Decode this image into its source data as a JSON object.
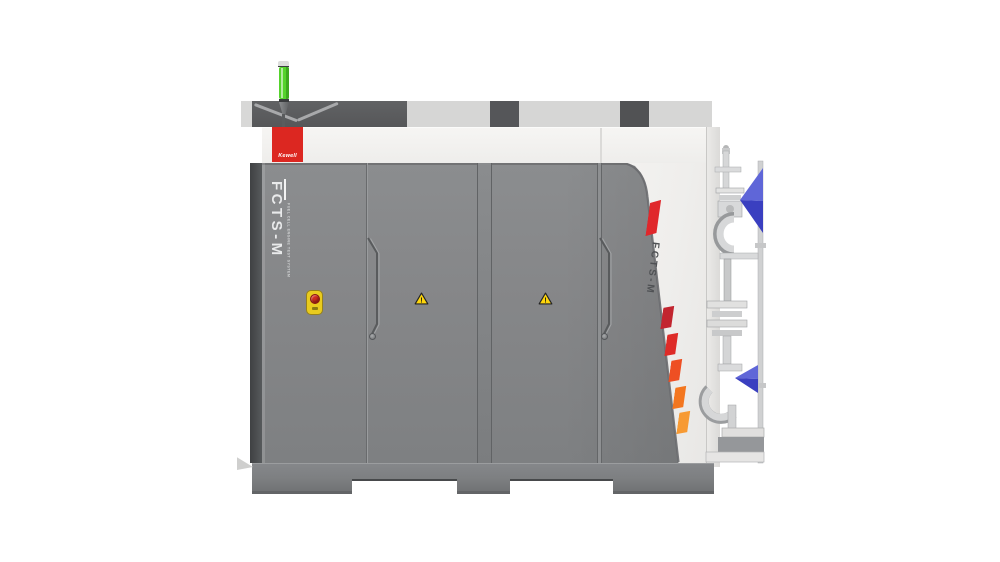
{
  "scene": {
    "background_color": "#ffffff",
    "subject": "Front product render of a Kewell FCTS-M fuel cell engine test system cabinet"
  },
  "machine": {
    "brand_logo": {
      "text": "Kewell",
      "bg_color": "#dc2721",
      "text_color": "#ffffff"
    },
    "status_beacon": {
      "color": "#55d32c"
    },
    "front_branding": {
      "model": "FCTS-M",
      "tagline": "FUEL CELL ENGINE TEST SYSTEM",
      "text_color": "#e9eaeb"
    },
    "side_branding": {
      "model": "FCTS-M",
      "text_color": "#4f5154"
    },
    "side_stripes": {
      "top_stripe_color": "#e0272b",
      "gradient_stripe_colors": [
        "#c2252f",
        "#de2b28",
        "#ee4f23",
        "#f3761f",
        "#f79a33"
      ]
    },
    "safety": {
      "warning_symbol": "!",
      "warning_color": "#ffd60b",
      "emergency_stop": {
        "plate_color": "#e9cb1e",
        "button_color": "#d22b1f"
      }
    },
    "valves": {
      "handle_color": "#3a3fc0",
      "handle_highlight_color": "#5f66d8"
    },
    "body_colors": {
      "door_gray": "#85878a",
      "edge_dark": "#4c4e50",
      "panel_white": "#f2f1ef",
      "plinth": "#7e8082"
    }
  }
}
